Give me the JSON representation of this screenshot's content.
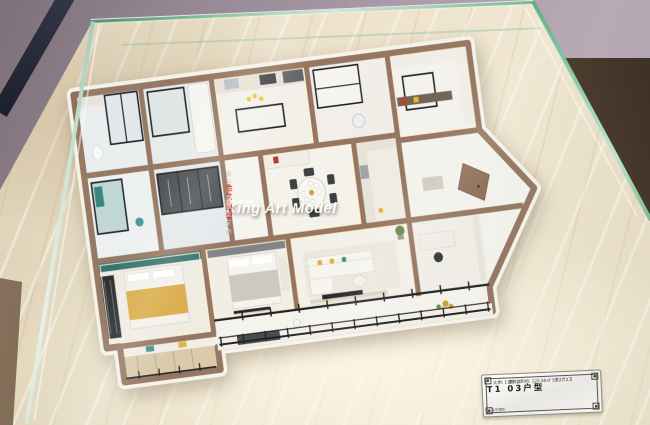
{
  "scene": {
    "subject": "apartment floor-plan scale model displayed inside a glass vitrine on a marble base",
    "colors": {
      "wall_background": "#a89aa6",
      "glass_edge_green": "#57a87e",
      "marble_base": "#ecdfc6",
      "model_wall_top": "#91705a",
      "model_floor": "#f2efe8",
      "window_frame_black": "#17181c",
      "accent_teal": "#3f8f8a",
      "bed_gold": "#d9a73c",
      "accent_red": "#c63326",
      "accent_yellow": "#e4b022",
      "door_wood": "#8a6750"
    },
    "model_rooms": [
      "bathroom",
      "shower-room",
      "kitchen",
      "laundry",
      "pantry-kitchen",
      "teal-bathroom",
      "walk-in-closet",
      "hallway",
      "dining-room",
      "foyer-with-diagonal-wall",
      "master-bedroom",
      "second-bedroom",
      "living-room",
      "study",
      "balcony",
      "storage-room"
    ]
  },
  "watermark": {
    "title": "King Art Model",
    "subtitle_cn": "金艺模型",
    "subtitle_rest": "专业沙盘模型定制",
    "title_color": "#ffffff",
    "subtitle_cn_color": "#e03325"
  },
  "plaque": {
    "title": "T1 03户型",
    "line2": "建筑面积约: 122.50㎡ 3室2厅2卫",
    "line3": "比例: 1:25",
    "maker_mark": "金艺模型"
  }
}
